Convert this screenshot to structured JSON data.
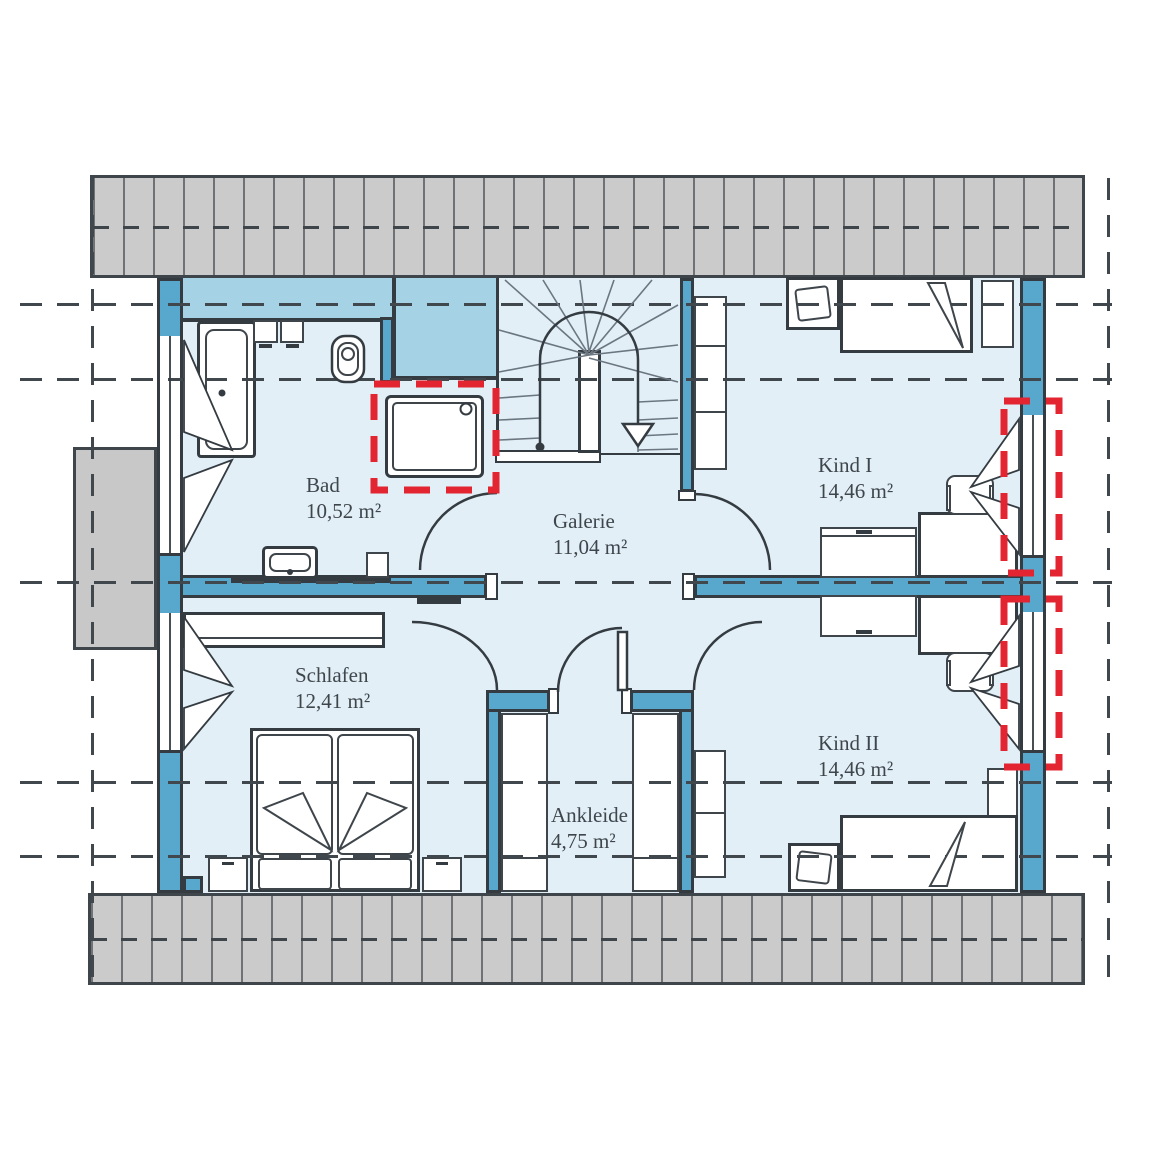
{
  "floorplan": {
    "title": "Dachgeschoss Grundriss",
    "rooms": [
      {
        "id": "bad",
        "label": "Bad",
        "area": "10,52 m²"
      },
      {
        "id": "galerie",
        "label": "Galerie",
        "area": "11,04 m²"
      },
      {
        "id": "kind1",
        "label": "Kind I",
        "area": "14,46 m²"
      },
      {
        "id": "kind2",
        "label": "Kind II",
        "area": "14,46 m²"
      },
      {
        "id": "schlafen",
        "label": "Schlafen",
        "area": "12,41 m²"
      },
      {
        "id": "ankleide",
        "label": "Ankleide",
        "area": "4,75 m²"
      }
    ],
    "colors": {
      "wall": "#57a8cc",
      "room_fill": "#e2eff7",
      "knee_zone": "#a6d2e6",
      "roof_band": "#cccbcb",
      "outline": "#343b41",
      "marker_red": "#e32531",
      "label_text": "#3e464b"
    }
  }
}
